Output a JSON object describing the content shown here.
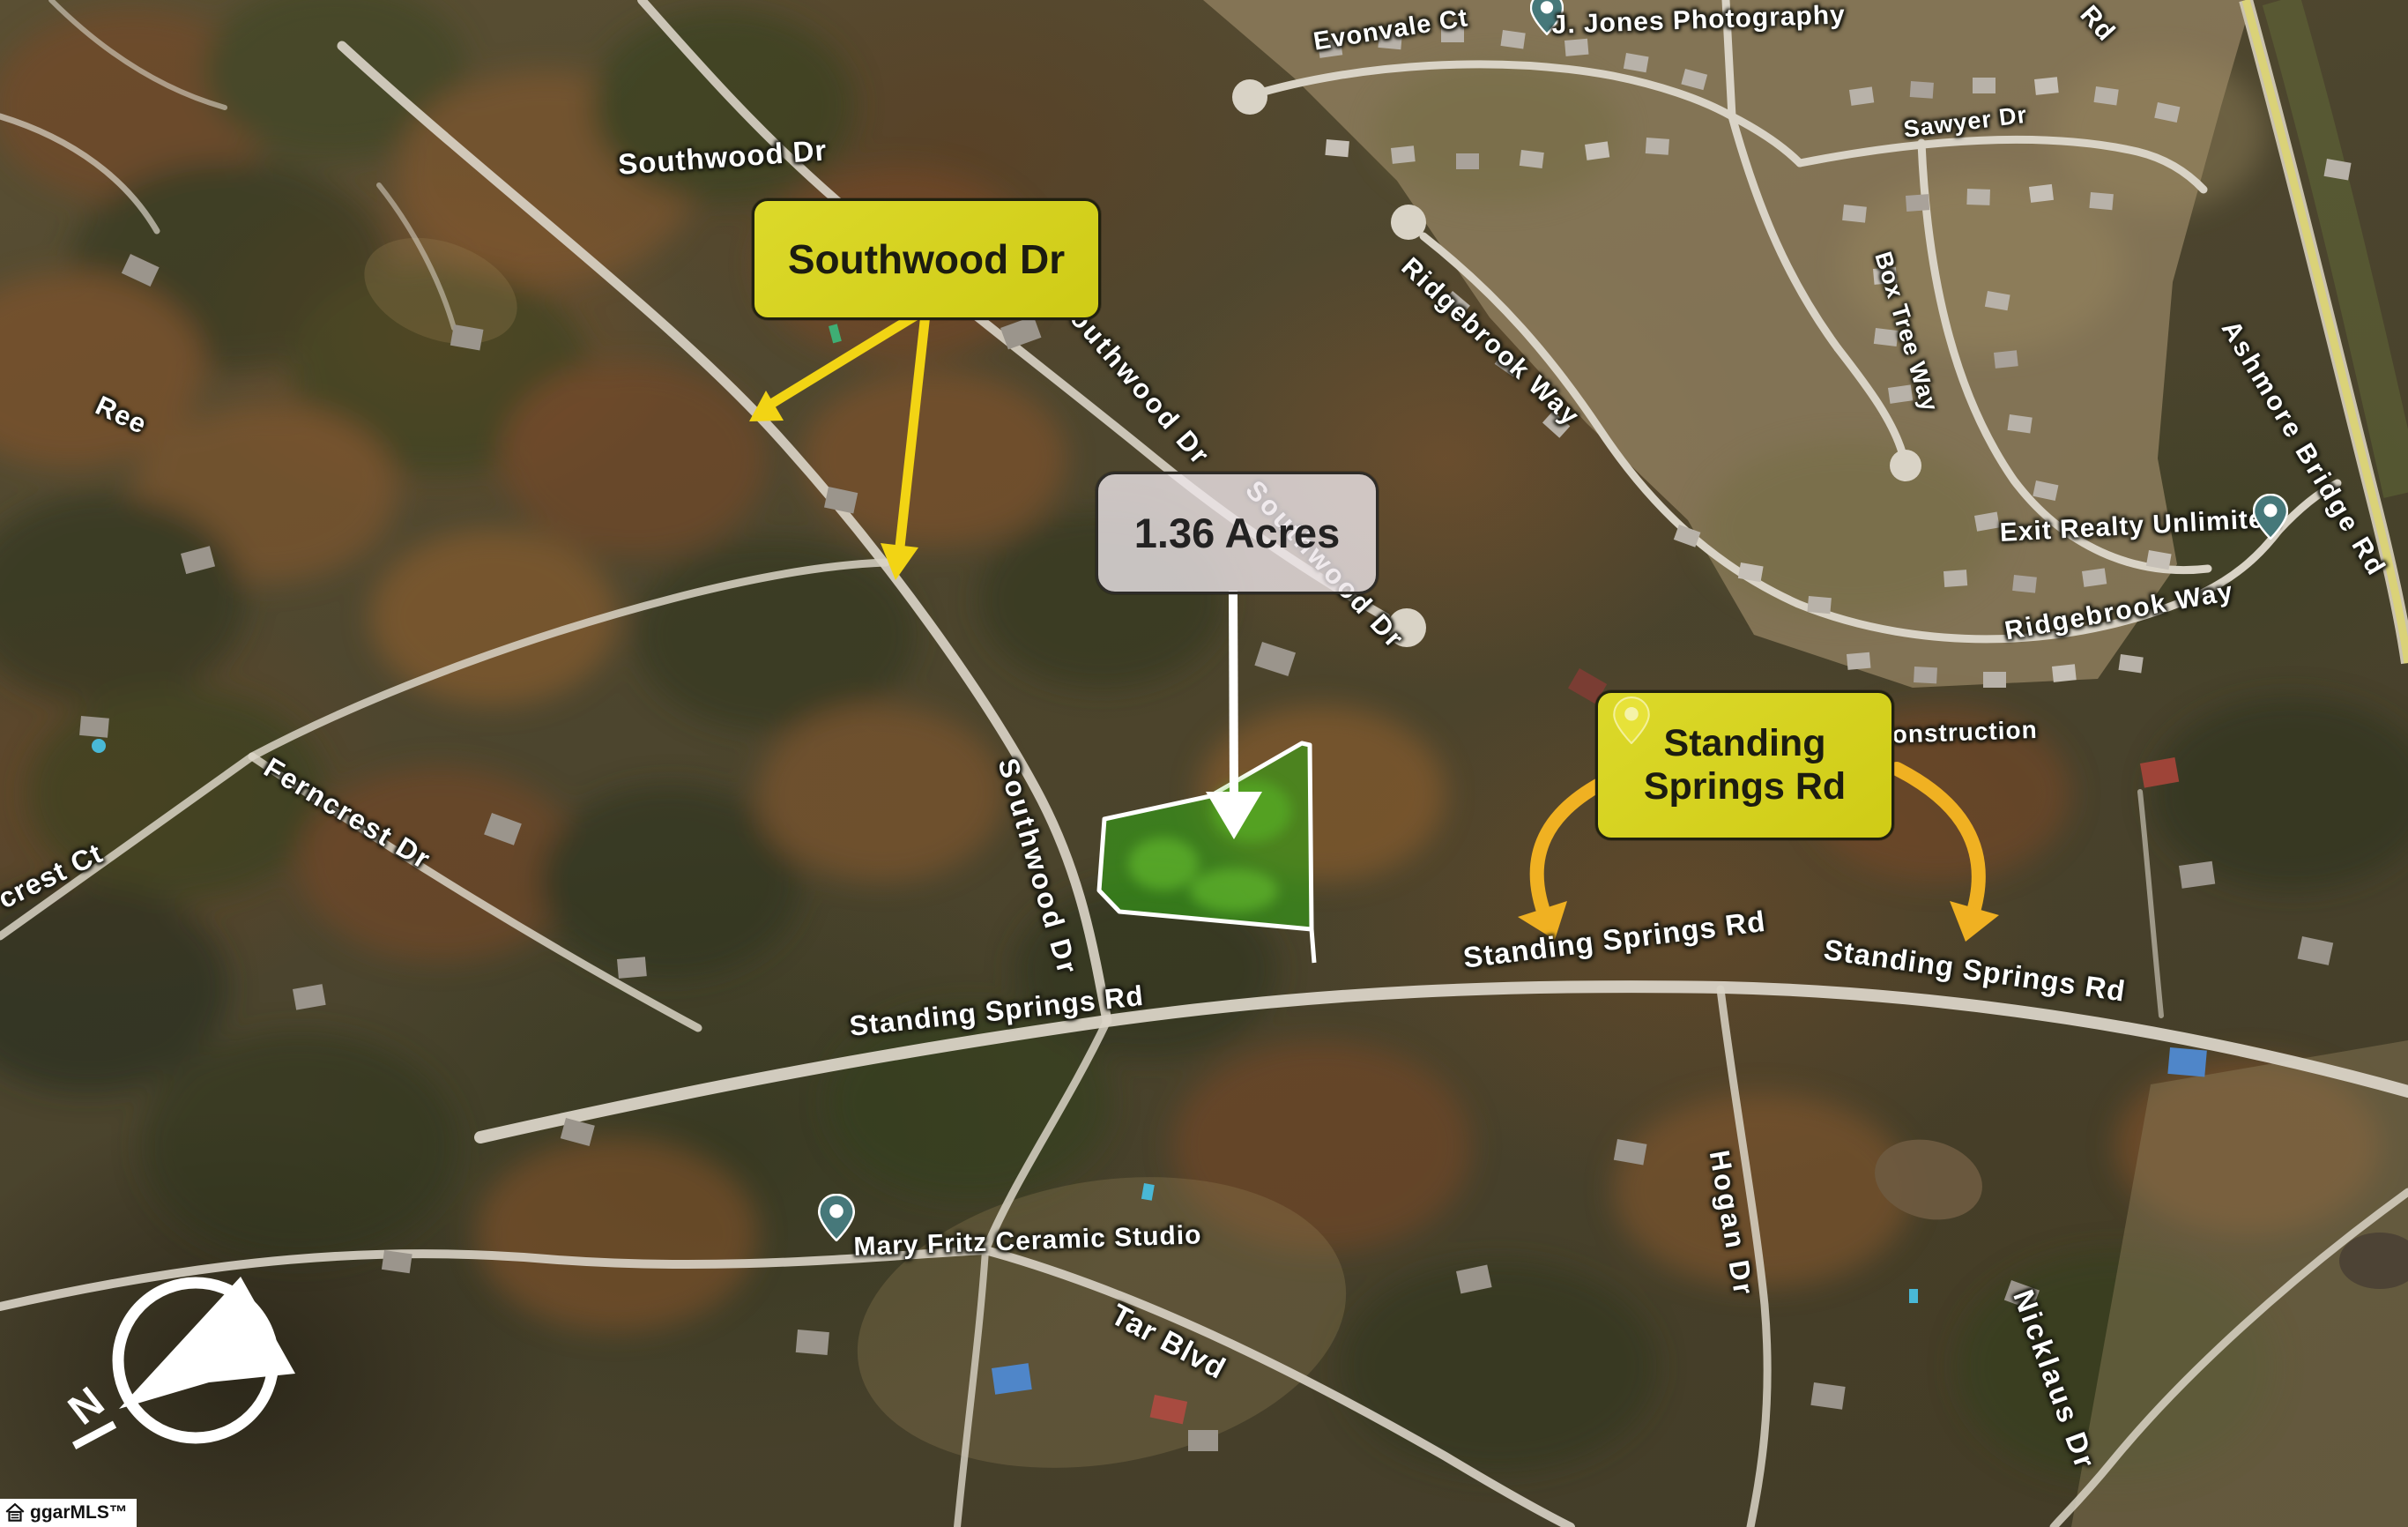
{
  "callouts": {
    "southwood": "Southwood Dr",
    "acres": "1.36 Acres",
    "standing_line1": "Standing",
    "standing_line2": "Springs Rd"
  },
  "streets": {
    "southwood_top": "Southwood Dr",
    "southwood_diag_upper": "Southwood Dr",
    "southwood_diag_lower": "Southwood Dr",
    "southwood_vertical": "Southwood Dr",
    "ree": "Ree",
    "ferncrest_dr": "Ferncrest Dr",
    "crest_ct": "crest Ct",
    "evonvale_ct": "Evonvale Ct",
    "sawyer_dr": "Sawyer Dr",
    "box_tree_way": "Box Tree Way",
    "ridgebrook_way_left": "Ridgebrook Way",
    "ridgebrook_way_right": "Ridgebrook Way",
    "ashmore_bridge_rd": "Ashmore Bridge Rd",
    "ashmore_rd_partial": "Rd",
    "standing_springs_left": "Standing Springs Rd",
    "standing_springs_mid": "Standing Springs Rd",
    "standing_springs_right": "Standing Springs Rd",
    "tar_blvd": "Tar Blvd",
    "hogan_dr": "Hogan Dr",
    "nicklaus_dr": "Nicklaus Dr"
  },
  "places": {
    "jones_photography": "J. Jones Photography",
    "exit_realty": "Exit Realty Unlimited",
    "mary_fritz": "Mary Fritz Ceramic Studio",
    "construction_partial": "ng Construction"
  },
  "compass": {
    "north": "N"
  },
  "watermark": "ggarMLS™",
  "colors": {
    "callout_yellow": "#d7d31d",
    "arrow_yellow": "#f2d414",
    "arrow_gold": "#f0b122",
    "parcel_green": "#34a017",
    "pin_teal": "#46787a",
    "acres_badge_bg": "#ece5e9",
    "road_gray": "#d9d3c6",
    "ashmore_highlight": "#e2da5a"
  }
}
